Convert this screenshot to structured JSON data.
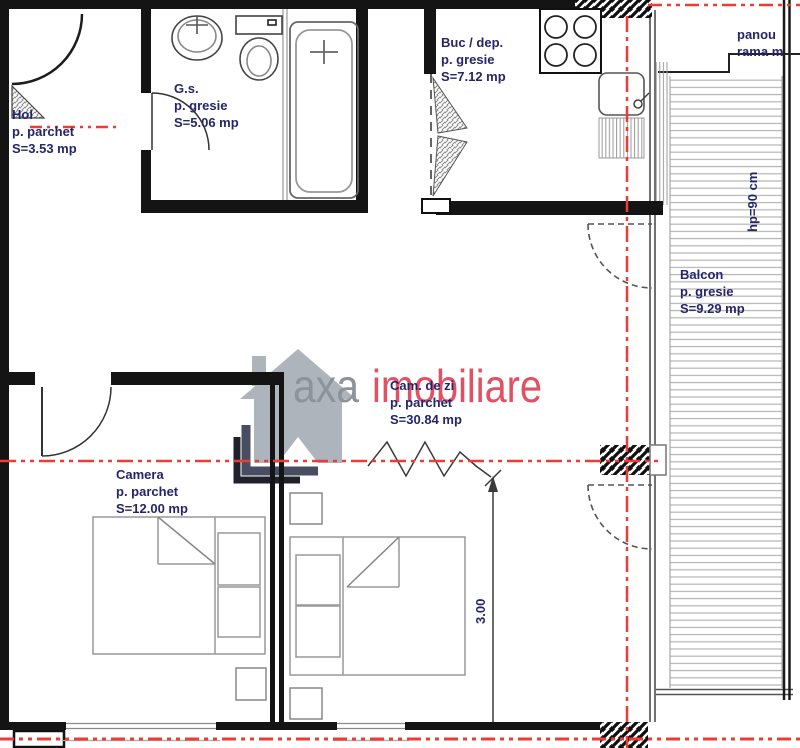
{
  "plan": {
    "rooms": {
      "hol": {
        "name": "Hol",
        "floor": "p. parchet",
        "area": "S=3.53 mp"
      },
      "gs": {
        "name": "G.s.",
        "floor": "p. gresie",
        "area": "S=5.06 mp"
      },
      "buc": {
        "name": "Buc / dep.",
        "floor": "p. gresie",
        "area": "S=7.12 mp"
      },
      "balcon": {
        "name": "Balcon",
        "floor": "p. gresie",
        "area": "S=9.29 mp"
      },
      "cam_de_zi": {
        "name": "Cam. de zi",
        "floor": "p. parchet",
        "area": "S=30.84 mp"
      },
      "camera": {
        "name": "Camera",
        "floor": "p. parchet",
        "area": "S=12.00 mp"
      }
    },
    "annotations": {
      "panou_line1": "panou",
      "panou_line2": "rama m",
      "parapet_height": "hp=90 cm",
      "dimension": "3.00"
    },
    "watermark": {
      "brand": "axa",
      "brand_suffix": "imobiliare"
    },
    "colors": {
      "axis_red": "#ee3b35",
      "label_ink": "#25256b",
      "watermark_gray": "#8d939c",
      "watermark_pink": "#e25064"
    }
  }
}
